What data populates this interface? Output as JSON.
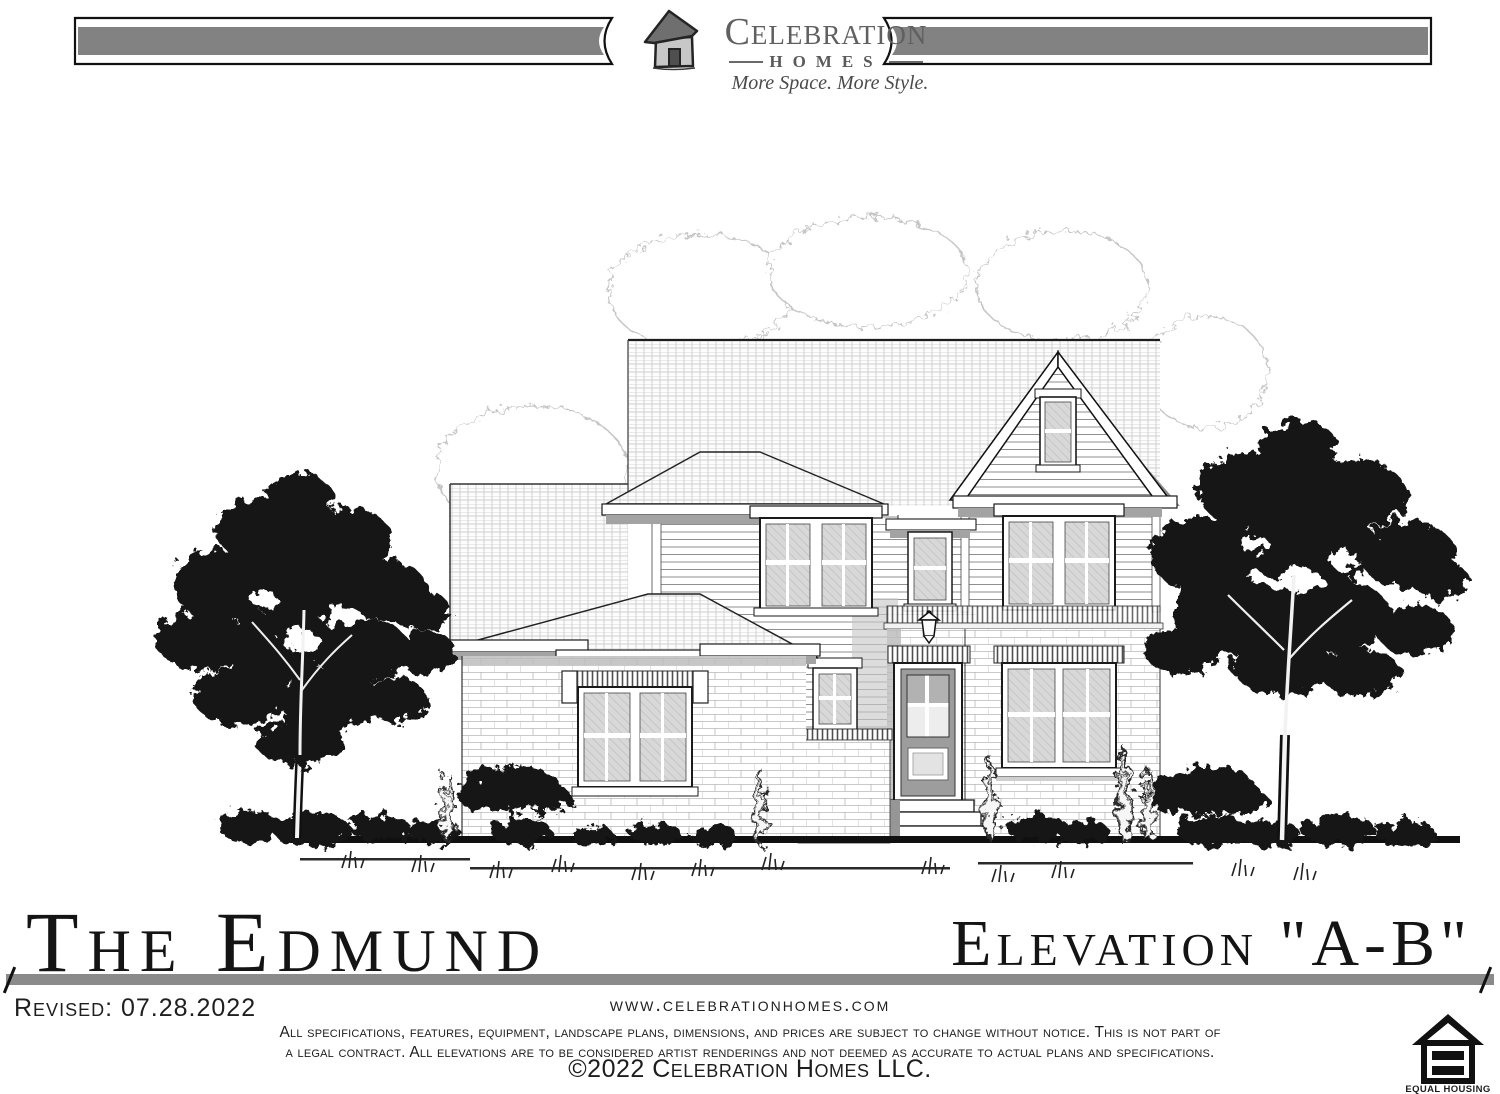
{
  "header": {
    "logo_icon": "house-sketch-icon",
    "brand": "Celebration",
    "brand_word2": "Homes",
    "tagline": "More Space. More Style."
  },
  "drawing": {
    "alt": "Front elevation of a two-story house with cross-hatched gable and hip roofs, lap siding upper floor, brick first floor, front door with steps, flanked by two large dark trees and shrubs"
  },
  "title_block": {
    "plan_name": "The Edmund",
    "elevation": "Elevation \"A-B\"",
    "revised": "Revised: 07.28.2022",
    "website": "www.celebrationhomes.com",
    "disclaimer": [
      "All specifications, features, equipment, landscape plans, dimensions, and prices are subject to change without notice.  This is not part of",
      "a legal contract.  All elevations are to be considered artist renderings and not deemed as accurate to actual plans and specifications."
    ],
    "copyright": "©2022 Celebration Homes LLC.",
    "equal_housing": {
      "icon": "equal-housing-icon",
      "line1": "EQUAL HOUSING",
      "line2": "OPPORTUNITY"
    }
  },
  "colors": {
    "ink": "#111111",
    "divider_gray": "#8a8a8a",
    "logo_gray": "#606060",
    "roof_shadow": "#8d8d8d",
    "glass": "#d8d8d8"
  }
}
